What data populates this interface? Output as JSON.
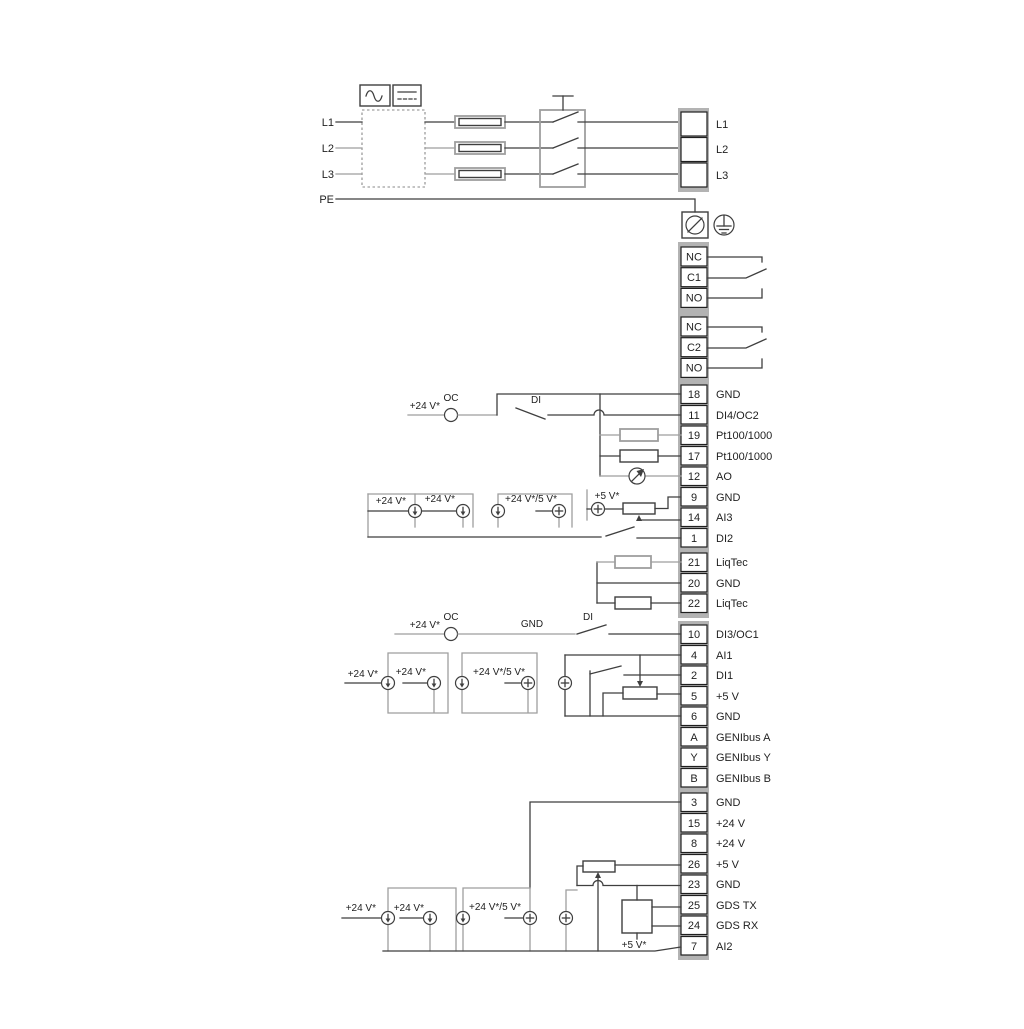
{
  "power": {
    "left_labels": [
      "L1",
      "L2",
      "L3",
      "PE"
    ],
    "right_labels": [
      "L1",
      "L2",
      "L3"
    ]
  },
  "relays": {
    "relay1": [
      "NC",
      "C1",
      "NO"
    ],
    "relay2": [
      "NC",
      "C2",
      "NO"
    ]
  },
  "strips": {
    "s1": [
      {
        "num": "18",
        "label": "GND"
      },
      {
        "num": "11",
        "label": "DI4/OC2"
      },
      {
        "num": "19",
        "label": "Pt100/1000"
      },
      {
        "num": "17",
        "label": "Pt100/1000"
      },
      {
        "num": "12",
        "label": "AO"
      },
      {
        "num": "9",
        "label": "GND"
      },
      {
        "num": "14",
        "label": "AI3"
      },
      {
        "num": "1",
        "label": "DI2"
      }
    ],
    "s2": [
      {
        "num": "21",
        "label": "LiqTec"
      },
      {
        "num": "20",
        "label": "GND"
      },
      {
        "num": "22",
        "label": "LiqTec"
      }
    ],
    "s3": [
      {
        "num": "10",
        "label": "DI3/OC1"
      },
      {
        "num": "4",
        "label": "AI1"
      },
      {
        "num": "2",
        "label": "DI1"
      },
      {
        "num": "5",
        "label": "+5 V"
      },
      {
        "num": "6",
        "label": "GND"
      },
      {
        "num": "A",
        "label": "GENIbus A"
      },
      {
        "num": "Y",
        "label": "GENIbus Y"
      },
      {
        "num": "B",
        "label": "GENIbus B"
      }
    ],
    "s4": [
      {
        "num": "3",
        "label": "GND"
      },
      {
        "num": "15",
        "label": "+24 V"
      },
      {
        "num": "8",
        "label": "+24 V"
      },
      {
        "num": "26",
        "label": "+5 V"
      },
      {
        "num": "23",
        "label": "GND"
      },
      {
        "num": "25",
        "label": "GDS TX"
      },
      {
        "num": "24",
        "label": "GDS RX"
      },
      {
        "num": "7",
        "label": "AI2"
      }
    ]
  },
  "annotations": {
    "oc": "OC",
    "di": "DI",
    "gnd": "GND",
    "v24": "+24 V*",
    "v24_5": "+24 V*/5 V*",
    "v5": "+5 V*"
  },
  "colors": {
    "wire_dark": "#3f3f3f",
    "wire_gray": "#9e9e9e",
    "terminal_backing": "#b3b3b3",
    "text": "#1f1f1f",
    "background": "#ffffff"
  }
}
